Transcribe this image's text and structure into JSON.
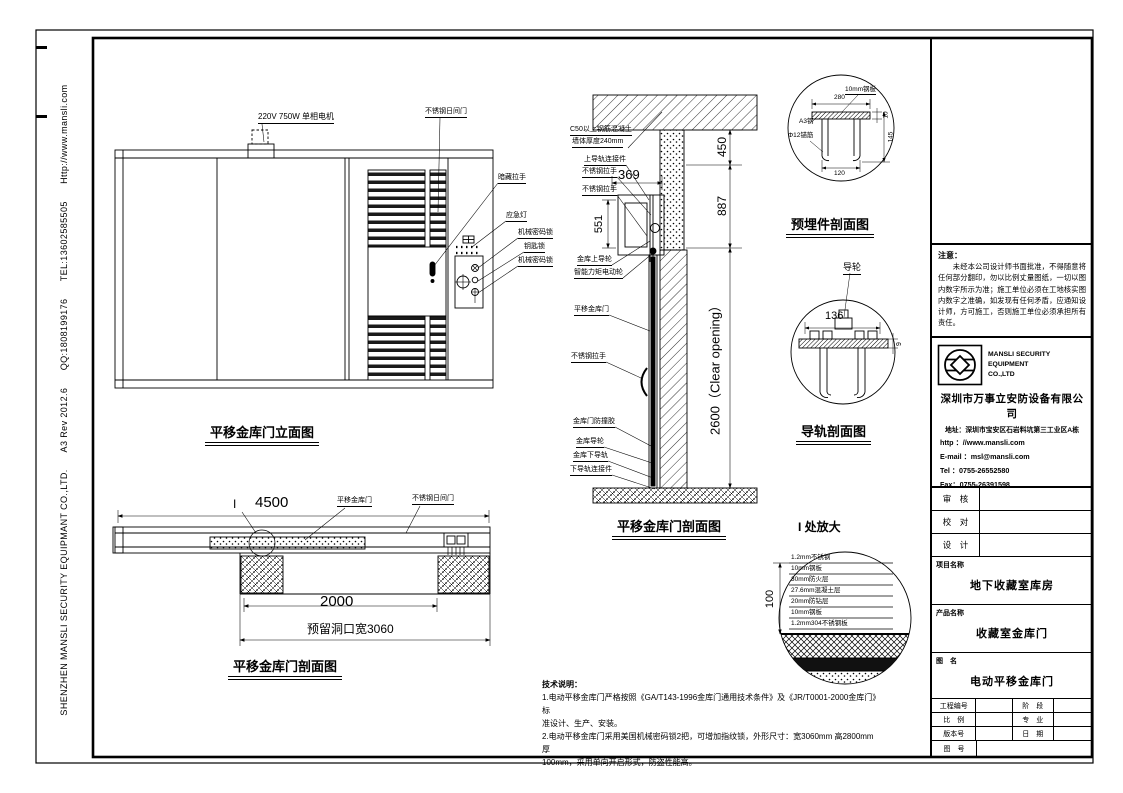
{
  "sheet": {
    "strip_text": "SHENZHEN MANSLI SECURITY EQUIPMANT CO.,LTD.      A3 Rev 2012.6      QQ:1808199176      TEL:13602585505      Http://www.mansli.com"
  },
  "elevation": {
    "caption": "平移金库门立面图",
    "motor_label": "220V 750W 单相电机",
    "day_gate_label": "不锈钢日间门",
    "callout_handle": "暗藏拉手",
    "callout_light": "应急灯",
    "callout_lock1": "机械密码锁",
    "callout_keylock": "钥匙锁",
    "callout_lock2": "机械密码锁"
  },
  "plan": {
    "caption": "平移金库门剖面图",
    "detail_marker": "I",
    "dim_total": "4500",
    "door_label": "平移金库门",
    "day_gate_label": "不锈钢日间门",
    "dim_opening": "2000",
    "reserved_label": "预留洞口宽3060"
  },
  "section": {
    "caption": "平移金库门剖面图",
    "wall_note1": "C50以上钢筋混凝土",
    "wall_note2": "墙体厚度240mm",
    "dim_369": "369",
    "dim_551": "551",
    "dim_450": "450",
    "dim_887": "887",
    "dim_clear": "2600（Clear opening）",
    "callout_top1": "上导轨连接件",
    "callout_top2": "不锈钢拉手",
    "callout_top3": "不锈钢拉手",
    "callout_top4": "金库上导轮",
    "callout_top5": "智能力矩电动轮",
    "callout_door": "平移金库门",
    "callout_handle": "不锈钢拉手",
    "callout_bumper": "金库门防撞胶",
    "callout_wheel": "金库导轮",
    "callout_rail": "金库下导轨",
    "callout_conn": "下导轨连接件"
  },
  "embed_detail": {
    "caption": "预埋件剖面图",
    "plate_label": "10mm钢板",
    "steel_label": "A3钢",
    "anchor_label": "Φ12锚筋",
    "dim_280": "280",
    "dim_10": "10",
    "dim_145": "145",
    "dim_120": "120"
  },
  "rail_detail": {
    "caption": "导轨剖面图",
    "wheel_label": "导轮",
    "dim_136": "136",
    "dim_9": "9"
  },
  "enlarged": {
    "caption": "I 处放大",
    "dim_100": "100",
    "layers": [
      "1.2mm不锈钢",
      "10mm钢板",
      "30mm防火层",
      "27.6mm混凝土层",
      "20mm防钻层",
      "10mm钢板",
      "1.2mm304不锈钢板"
    ]
  },
  "tech_notes": {
    "title": "技术说明：",
    "lines": [
      "1.电动平移金库门严格按照《GA/T143-1996金库门通用技术条件》及《JR/T0001-2000金库门》标",
      "准设计、生产、安装。",
      "2.电动平移金库门采用美国机械密码锁2把，可增加指纹锁，外形尺寸：宽3060mm 高2800mm 厚",
      "100mm，采用单向开启形式，防盗性能高。"
    ]
  },
  "title_block": {
    "note_title": "注意：",
    "note_body": "　　未经本公司设计师书面批准，不得随意将任何部分翻印，勿以比例丈量图纸，一切以图内数字所示为准；施工单位必须在工地核实图内数字之准确，如发现有任何矛盾，应通知设计师，方可施工，否则施工单位必须承担所有责任。",
    "logo_line1": "MANSLI SECURITY",
    "logo_line2": "EQUIPMENT",
    "logo_line3": "CO.,LTD",
    "company_cn": "深圳市万事立安防设备有限公司",
    "address": "地址：深圳市宝安区石岩料坑第三工业区A栋",
    "http": "http ：//www.mansli.com",
    "email": "E-mail ：msl@mansli.com",
    "tel": "Tel ：0755-26552580",
    "fax": "Fax：0755-26391598",
    "row_review": "审　核",
    "row_check": "校　对",
    "row_design": "设　计",
    "project_label": "项目名称",
    "project_value": "地下收藏室库房",
    "product_label": "产品名称",
    "product_value": "收藏室金库门",
    "drawing_label": "图　名",
    "drawing_value": "电动平移金库门",
    "grid": [
      {
        "l1": "工程编号",
        "l2": "阶　段"
      },
      {
        "l1": "比　例",
        "l2": "专　业"
      },
      {
        "l1": "版本号",
        "l2": "日　期"
      }
    ],
    "drawing_no_label": "图　号"
  }
}
